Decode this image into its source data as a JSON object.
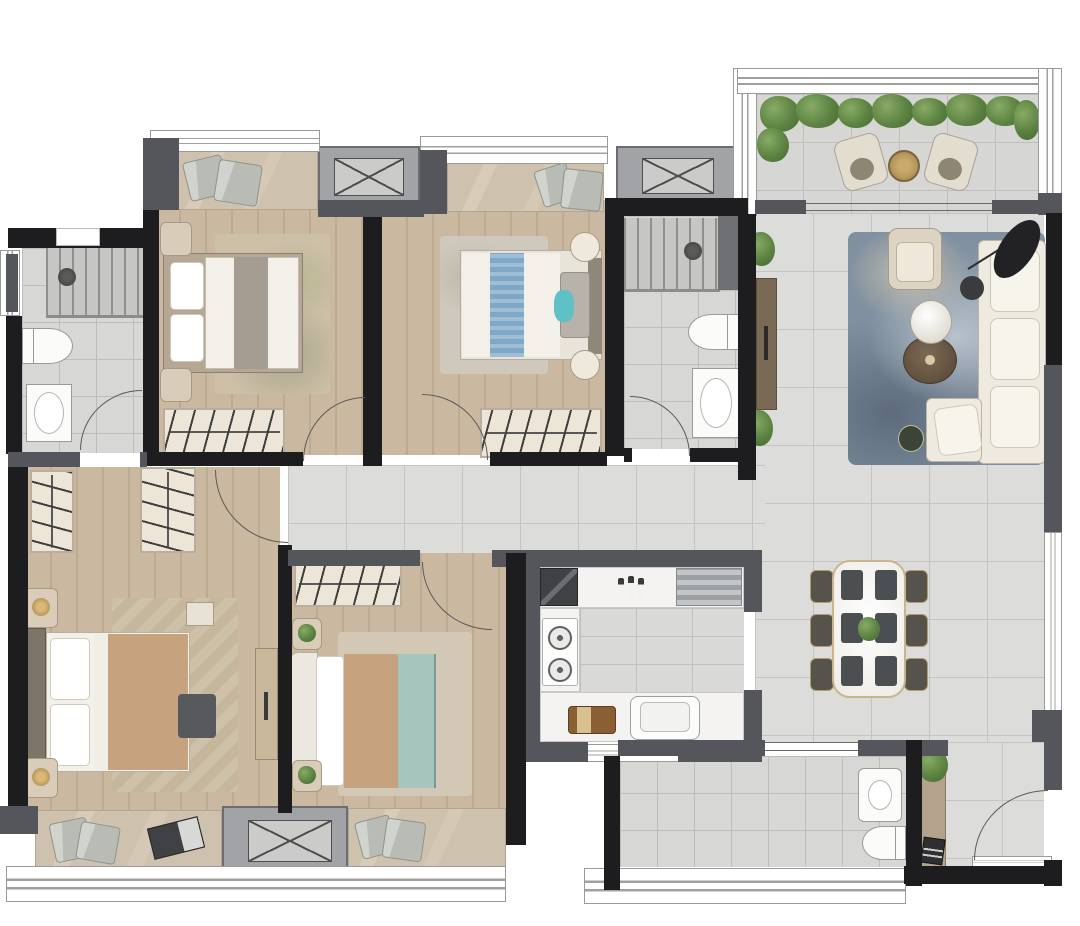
{
  "document": {
    "kind": "residential-floor-plan-rendering",
    "view": "top-down",
    "visible_text": "none"
  },
  "palette": {
    "wall_black": "#1d1d1f",
    "wall_gray": "#55565b",
    "win_line": "#a0a09e",
    "wood": "#cbb8a1",
    "wood_line": "#bdaa91",
    "tile": "#dcdcda",
    "tile_line": "#c4c4c1",
    "bath_tile": "#d7d7d5",
    "bath_line": "#bdbdba",
    "sill": "#cec1ad",
    "sill_line": "#b2a691",
    "counter": "#f4f3f1",
    "fixture": "#fbfbfa",
    "fixture_line": "#9a9a98",
    "sofa": "#efeadf",
    "bed_white": "#f3f0e9",
    "blanket_tan": "#c6a37e",
    "blanket_teal": "#a5c5bd",
    "runner_blue": "#7fa7c7",
    "teal_accent": "#5fc0c5",
    "brown": "#6d5b49",
    "gold": "#b79a6b",
    "green_a": "#88ab66",
    "green_b": "#446b33",
    "rug_blue": "#8090a0",
    "rug_beige": "#cec1aa",
    "dark_item": "#3a3b3e"
  },
  "rooms": [
    {
      "id": "bedroom-top-left",
      "floor": "wood-plank",
      "furniture": [
        "bay-window-seat-with-2-cushions",
        "double-bed-gray-runner",
        "nightstand-x2",
        "wardrobe-with-hangers",
        "leaf-pattern-rug",
        "swing-door"
      ]
    },
    {
      "id": "bedroom-top-middle",
      "floor": "wood-plank",
      "furniture": [
        "bay-window-seat-with-2-cushions",
        "double-bed-blue-runner",
        "round-nightstand-x2",
        "wardrobe-with-hangers",
        "rug",
        "swing-door"
      ]
    },
    {
      "id": "master-bathroom-left",
      "floor": "bath-tile",
      "furniture": [
        "walk-in-shower",
        "shower-head",
        "toilet",
        "washbasin",
        "swing-door",
        "side-window"
      ]
    },
    {
      "id": "bathroom-middle",
      "floor": "bath-tile",
      "furniture": [
        "walk-in-shower",
        "shower-head",
        "water-heater-block",
        "toilet",
        "washbasin",
        "swing-door"
      ]
    },
    {
      "id": "balcony",
      "floor": "outdoor-tile",
      "furniture": [
        "planting-hedge",
        "lounge-chair-x2",
        "round-side-table",
        "sliding-door"
      ]
    },
    {
      "id": "living-room",
      "floor": "marble-tile",
      "furniture": [
        "abstract-blue-rug",
        "three-seat-sofa",
        "chaise-section",
        "armchair",
        "round-coffee-table-white",
        "round-coffee-table-brown",
        "side-table",
        "arc-floor-lamp",
        "tv-cabinet",
        "potted-plant-x2"
      ]
    },
    {
      "id": "dining-area",
      "floor": "marble-tile",
      "furniture": [
        "dining-table",
        "dining-chair-x6",
        "placemat-x6",
        "centerpiece-plant"
      ]
    },
    {
      "id": "corridor",
      "floor": "marble-tile",
      "furniture": []
    },
    {
      "id": "master-bedroom",
      "floor": "wood-plank",
      "furniture": [
        "wardrobe-with-hangers-x2",
        "king-bed",
        "bed-end-bench",
        "nightstand-x2",
        "herringbone-rug",
        "dresser",
        "bay-window-seat-with-cushions-and-laptop"
      ]
    },
    {
      "id": "bedroom-bottom-middle",
      "floor": "wood-plank",
      "furniture": [
        "wardrobe-with-hangers",
        "double-bed-teal-blanket",
        "nightstand-x2",
        "rug",
        "bay-window-seat-with-2-cushions",
        "swing-door"
      ]
    },
    {
      "id": "kitchen",
      "floor": "marble-tile",
      "furniture": [
        "l-shaped-counter",
        "dark-counter-module",
        "bottle-x3",
        "stainless-appliance",
        "gas-cooktop-2-burner",
        "sink",
        "cutting-board",
        "window"
      ]
    },
    {
      "id": "guest-bathroom-bottom",
      "floor": "bath-tile",
      "furniture": [
        "vanity-basin",
        "toilet",
        "sliding-door",
        "window-wall"
      ]
    },
    {
      "id": "entry",
      "floor": "marble-tile",
      "furniture": [
        "shoe-cabinet",
        "potted-plant",
        "doormat",
        "entry-swing-door"
      ]
    }
  ],
  "counts": {
    "bedrooms": 4,
    "bathrooms": 3,
    "balconies": 1,
    "dining_chairs": 6,
    "placemats": 6,
    "lounge_chairs": 2,
    "ac_platforms_with_x_mark": 3,
    "swing_doors": 7,
    "wardrobes": 5
  }
}
